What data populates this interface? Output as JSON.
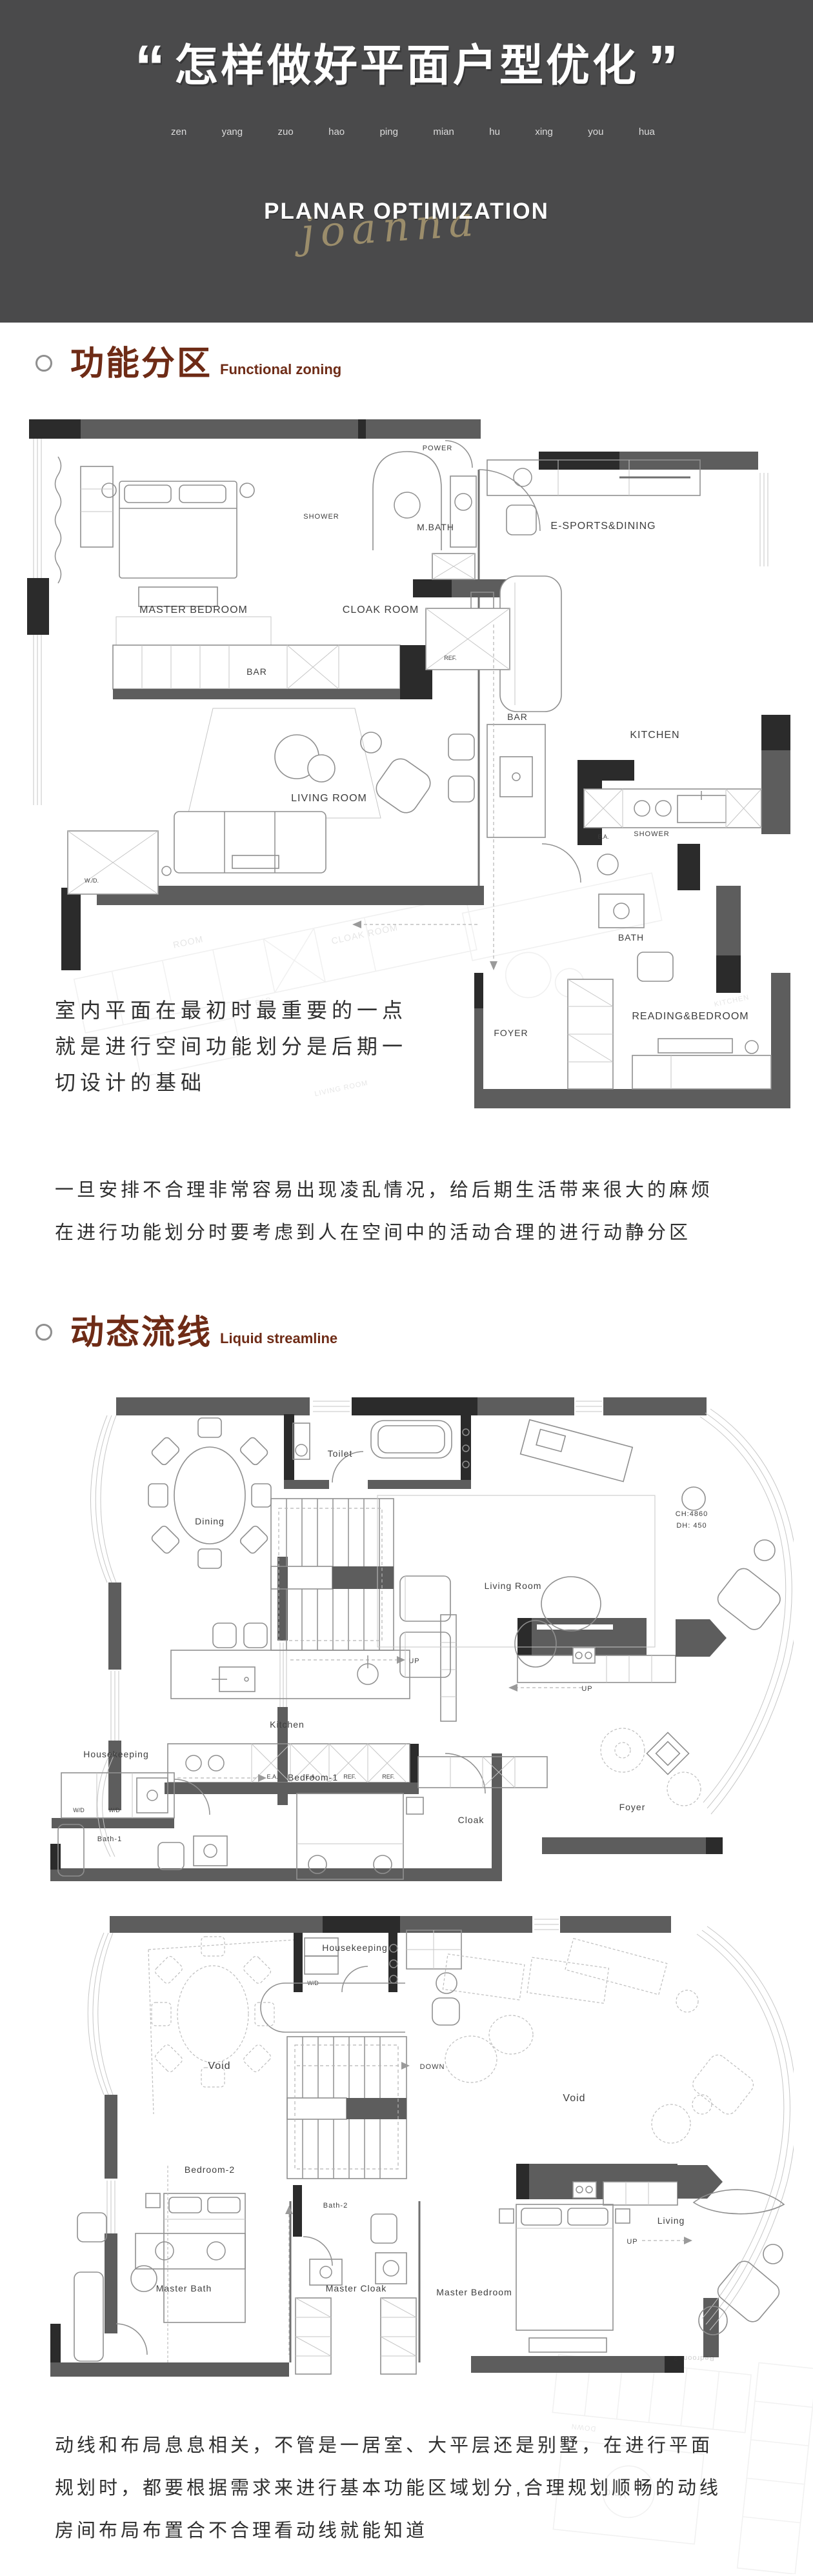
{
  "colors": {
    "headerBg": "#4a4a4b",
    "accent": "#6e2b16",
    "pinyin": "#dcdcdc",
    "signature": "#b09e74",
    "body": "#2f2f2f",
    "wall": "#5d5d5d",
    "wallDark": "#2b2b2b",
    "line": "#8f8f8f",
    "lineLight": "#c6c6c6",
    "label": "#3e3e3e"
  },
  "header": {
    "quote_open": "“",
    "quote_close": "”",
    "title": "怎样做好平面户型优化",
    "pinyin": [
      "zen",
      "yang",
      "zuo",
      "hao",
      "ping",
      "mian",
      "hu",
      "xing",
      "you",
      "hua"
    ],
    "subtitle": "PLANAR OPTIMIZATION",
    "signature": "joanna"
  },
  "sections": [
    {
      "title_cn": "功能分区",
      "title_en": "Functional zoning"
    },
    {
      "title_cn": "动态流线",
      "title_en": "Liquid streamline"
    }
  ],
  "paragraphs": {
    "p1_lines": [
      "室内平面在最初时最重要的一点",
      "就是进行空间功能划分是后期一",
      "切设计的基础"
    ],
    "p2_lines": [
      "一旦安排不合理非常容易出现凌乱情况，给后期生活带来很大的麻烦",
      "在进行功能划分时要考虑到人在空间中的活动合理的进行动静分区"
    ],
    "p3_lines": [
      "动线和布局息息相关，不管是一居室、大平层还是别墅，在进行平面",
      "规划时，都要根据需求来进行基本功能区域划分,合理规划顺畅的动线",
      "房间布局布置合不合理看动线就能知道"
    ]
  },
  "plan1": {
    "labels": {
      "power": "POWER",
      "shower_a": "SHOWER",
      "m_bath": "M.BATH",
      "master_bedroom": "MASTER BEDROOM",
      "cloak_room": "CLOAK ROOM",
      "bar_a": "BAR",
      "e_sports": "E-SPORTS&DINING",
      "ref": "REF.",
      "bar_b": "BAR",
      "kitchen": "KITCHEN",
      "living_room": "LIVING ROOM",
      "wd": "W./D.",
      "shower_b": "SHOWER",
      "bath": "BATH",
      "ea": "E.A.",
      "reading_bedroom": "READING&BEDROOM",
      "foyer": "FOYER"
    },
    "ghost": {
      "room": "ROOM",
      "cloak": "CLOAK ROOM",
      "bar": "BAR",
      "living": "LIVING ROOM",
      "kitchen": "KITCHEN"
    }
  },
  "plan2": {
    "labels": {
      "toilet": "Toilet",
      "dining": "Dining",
      "up_a": "UP",
      "living_room": "Living Room",
      "ch": "CH:4860",
      "dh": "DH: 450",
      "kitchen": "Kitchen",
      "housekeeping": "Housekeeping",
      "wd_a": "W/D",
      "wd_b": "W/D",
      "ea_a": "E.A.",
      "ea_b": "E.A.",
      "ref_a": "REF.",
      "ref_b": "REF.",
      "bath1": "Bath-1",
      "bedroom1": "Bedroom-1",
      "cloak": "Cloak",
      "foyer": "Foyer",
      "up_b": "UP"
    }
  },
  "plan3": {
    "labels": {
      "housekeeping": "Housekeeping",
      "wd": "W/D",
      "void_a": "Void",
      "down": "DOWN",
      "void_b": "Void",
      "bedroom2": "Bedroom-2",
      "bath2": "Bath-2",
      "master_bath": "Master Bath",
      "master_cloak": "Master Cloak",
      "master_bedroom": "Master Bedroom",
      "up": "UP",
      "living": "Living",
      "ghost_bedroom2": "Bedroom-2"
    }
  },
  "ghost_bottom": {
    "void": "Void",
    "down": "DOWN"
  }
}
